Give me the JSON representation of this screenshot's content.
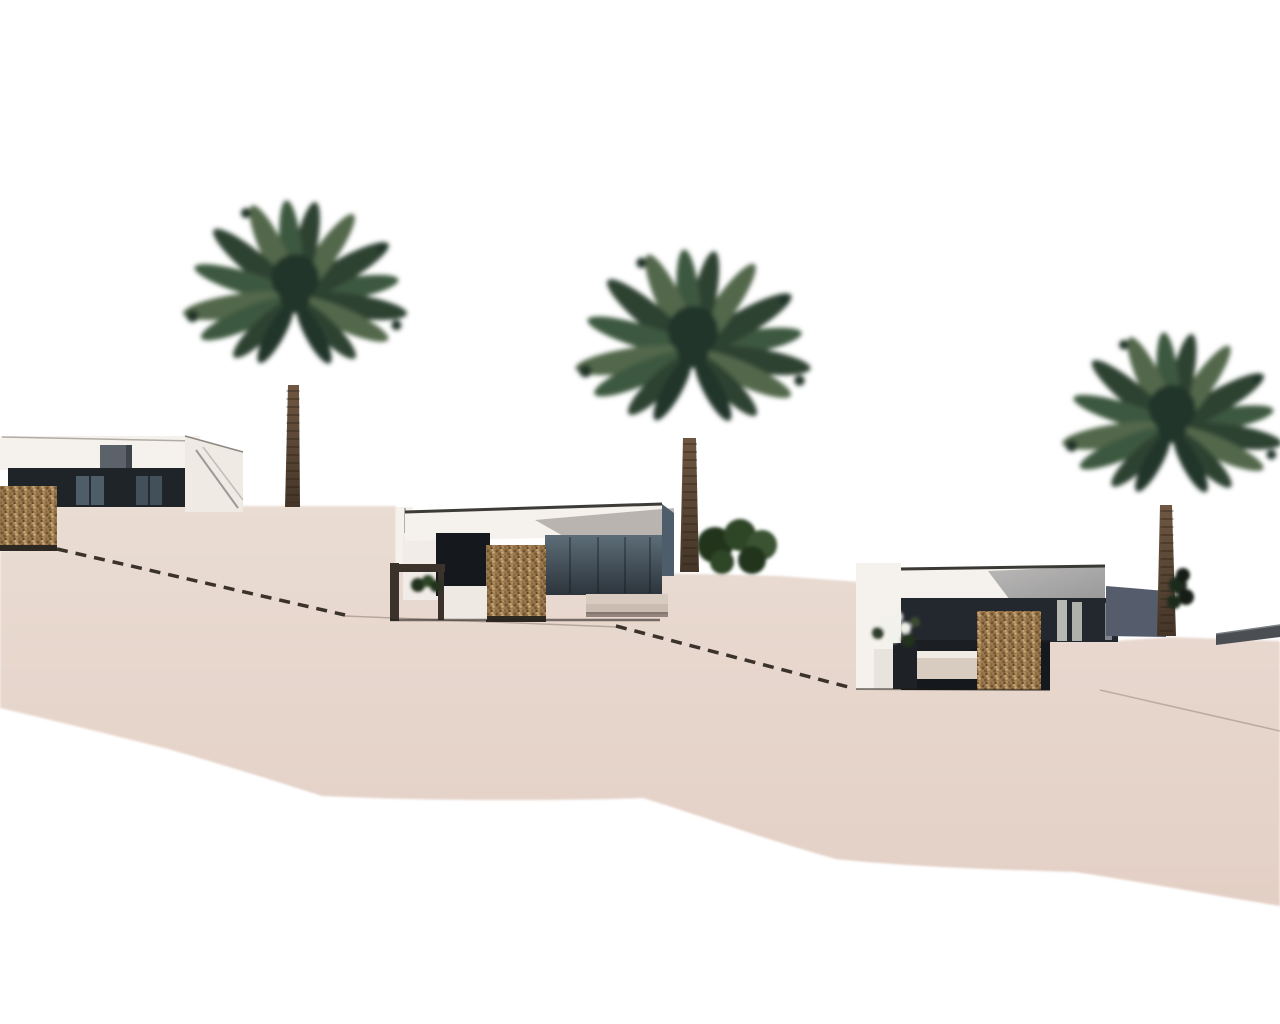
{
  "scene": {
    "title": "Architectural 3D render — terraced hillside villas with palm trees",
    "background": "#ffffff",
    "villa_count": 3,
    "palm_tree_count": 3,
    "gabion_pillar_count": 3,
    "handrail_count": 2,
    "objects": [
      {
        "name": "villa-left",
        "description": "white modern single-storey villa, dark glazing band, grey roof box, gabion stone pillar"
      },
      {
        "name": "villa-middle",
        "description": "white villa with dark glazed facade, terrace railing, gabion pillar, stone bench"
      },
      {
        "name": "villa-right",
        "description": "villa with charcoal glazed facade, blue-grey wing, gabion pillar, planter with white flowers, bench"
      },
      {
        "name": "palm-tree-left",
        "description": "date palm behind left villa"
      },
      {
        "name": "palm-tree-middle",
        "description": "date palm behind middle villa with shrub at base"
      },
      {
        "name": "palm-tree-right",
        "description": "date palm behind right villa"
      },
      {
        "name": "terraced-ground",
        "description": "beige stepped terrain sloping down to the right with two dashed handrails"
      },
      {
        "name": "boundary-wall-right",
        "description": "low grey wall at far right"
      }
    ]
  },
  "palette": {
    "ground": "#e6d6cc",
    "ground_deep": "#e3cfc5",
    "wall_white": "#f5f1ec",
    "fascia_shadow": "#b7b1ac",
    "glazing_dark": "#1f2429",
    "glazing_reflection": "#52616c",
    "facade_dark": "#23282e",
    "wing_blue": "#555c6c",
    "gabion": "#9b7a50",
    "gabion_dark": "#6b512f",
    "gabion_light": "#c8a46f",
    "palm_dark": "#22362a",
    "palm_mid": "#2d4331",
    "palm_mid2": "#3e5941",
    "palm_light": "#53684b",
    "trunk": "#6f5742",
    "trunk_dark": "#443528",
    "railing": "#3a322b",
    "bench": "#d8cbc0",
    "wall_grey": "#4b4e52",
    "door_light": "#b6b8b2",
    "chimney_grey": "#5c6269"
  }
}
